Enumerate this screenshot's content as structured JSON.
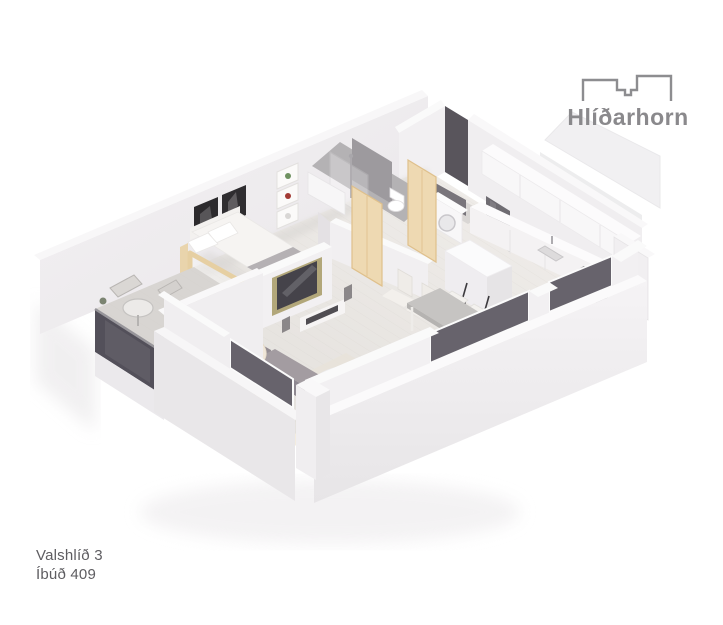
{
  "page": {
    "background": "#ffffff"
  },
  "logo": {
    "name": "Hlíðarhorn",
    "icon": "building-outline-icon",
    "color": "#8a898c"
  },
  "caption": {
    "line1": "Valshlíð 3",
    "line2": "Íbúð 409",
    "color": "#5e5d61"
  },
  "floorplan": {
    "kind": "isometric-3d-apartment-render",
    "rooms": [
      "bedroom",
      "bathroom",
      "laundry-nook",
      "entry",
      "kitchen",
      "dining-area",
      "living-room",
      "balcony"
    ],
    "furniture": [
      "double-bed",
      "wall-art",
      "wall-shelves",
      "tv-partition-wall",
      "media-console",
      "glass-door",
      "shower",
      "toilet",
      "vanity",
      "washing-machine",
      "kitchen-counter",
      "tall-cabinet",
      "island",
      "bar-stools",
      "dining-table",
      "dining-chairs",
      "corner-sofa",
      "armchair",
      "ottoman",
      "round-coffee-table",
      "rug",
      "balcony-table",
      "balcony-chairs"
    ],
    "colors": {
      "walls": "#f0eef0",
      "wall_shadow": "#e2dfe2",
      "floor_wood": "#eae7e4",
      "bathroom_floor": "#b4b2b4",
      "balcony_floor": "#d8d5d2",
      "door_wood": "#eed9b2",
      "window_glass": "#67636c",
      "balustrade_glass": "#53505a",
      "sofa_gray": "#9a939a",
      "cushion_cream": "#f0e7d9",
      "tv_frame_gold": "#b2a77a",
      "tv_screen": "#45434a",
      "dining_table_top": "#c6c4c2",
      "stool_legs": "#3c3a3e"
    }
  }
}
